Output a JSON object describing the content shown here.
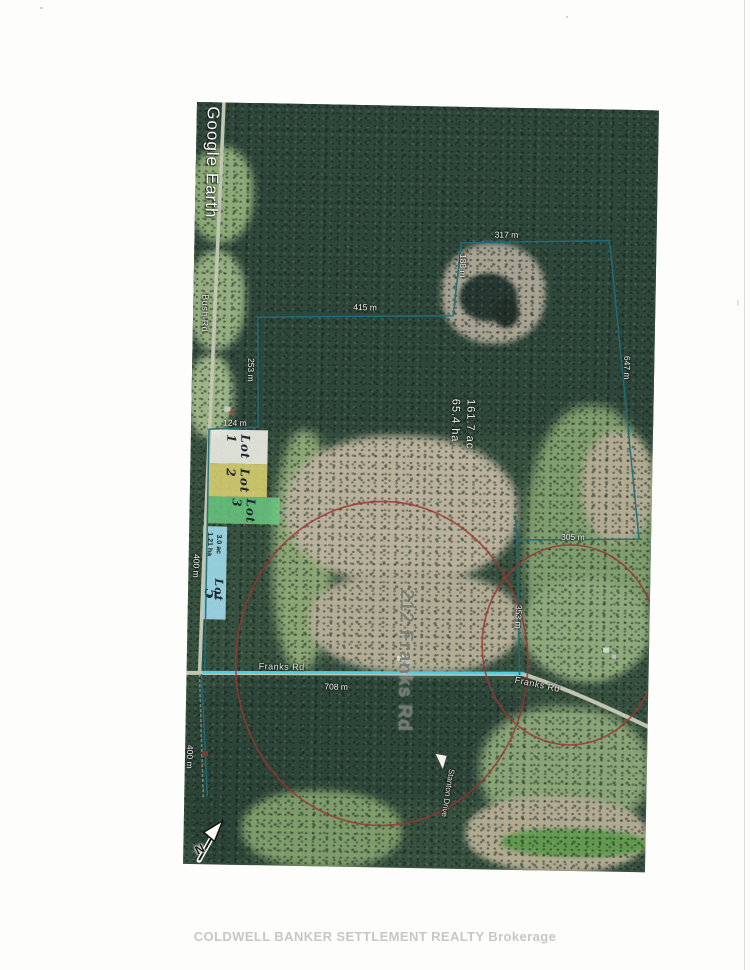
{
  "page": {
    "footer_brand": "COLDWELL BANKER SETTLEMENT REALTY  Brokerage"
  },
  "map": {
    "source_watermark": "Google Earth",
    "north_label": "N",
    "address_label": "212 Franks Rd",
    "area": {
      "acres": "161.7 ac",
      "hectares": "65.4 ha"
    },
    "roads": {
      "bush_rd": "Bush Rd",
      "franks_rd_west": "Franks Rd",
      "franks_rd_east": "Franks Rd",
      "stanton_drive": "Stanton Drive"
    },
    "measurements": {
      "top_parcel_width": "317 m",
      "top_parcel_side": "188 m",
      "north_line": "415 m",
      "west_upper": "253 m",
      "west_jog": "124 m",
      "east_diagonal": "647 m",
      "mid_east_width": "305 m",
      "mid_east_side": "353 m",
      "franks_rd_frontage": "708 m",
      "bush_rd_frontage": "400 m",
      "south_depth": "400 m"
    },
    "lots": {
      "lot1": {
        "label": "Lot 1"
      },
      "lot2": {
        "label": "Lot 2"
      },
      "lot3": {
        "label": "Lot 3"
      },
      "lot5": {
        "word": "Lot",
        "number": "5",
        "area_ac": "3.0 ac",
        "area_ha": "1.21 ha"
      }
    },
    "colors": {
      "boundary_teal": "#1e6f7c",
      "road_highlight_cyan": "#3fd0ea",
      "radius_circle_red": "#9c3531",
      "lot1_fill": "#e9ebe2",
      "lot2_fill": "#e0d572",
      "lot3_fill": "#6fd085",
      "lot5_fill": "#a4def2"
    }
  }
}
